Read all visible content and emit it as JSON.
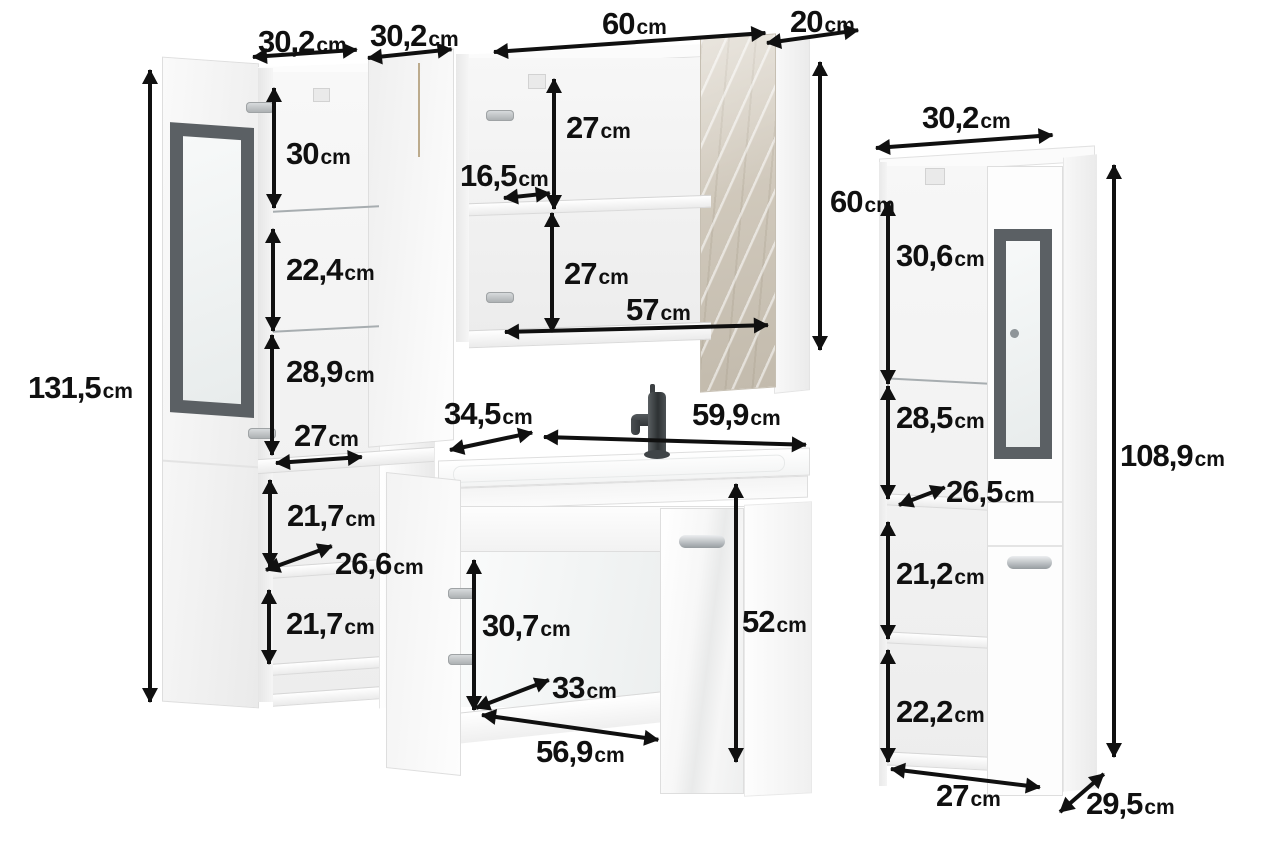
{
  "scene": {
    "background": "#ffffff",
    "arrow_color": "#101010",
    "text_color": "#101010",
    "glass_frame_color": "#5b6064",
    "marble_door_color": "#d1cabe"
  },
  "left_cabinet": {
    "description": "tall cabinet with open glass door",
    "dims": {
      "door_width": {
        "v": "30,2",
        "u": "cm"
      },
      "body_width": {
        "v": "30,2",
        "u": "cm"
      },
      "height": {
        "v": "131,5",
        "u": "cm"
      },
      "section_1": {
        "v": "30",
        "u": "cm"
      },
      "section_2": {
        "v": "22,4",
        "u": "cm"
      },
      "section_3": {
        "v": "28,9",
        "u": "cm"
      },
      "inner_width": {
        "v": "27",
        "u": "cm"
      },
      "section_4": {
        "v": "21,7",
        "u": "cm"
      },
      "inner_depth": {
        "v": "26,6",
        "u": "cm"
      },
      "section_5": {
        "v": "21,7",
        "u": "cm"
      }
    }
  },
  "mirror_cabinet": {
    "description": "wall cabinet with open doors",
    "dims": {
      "width": {
        "v": "60",
        "u": "cm"
      },
      "depth": {
        "v": "20",
        "u": "cm"
      },
      "section_top": {
        "v": "27",
        "u": "cm"
      },
      "shelf_depth": {
        "v": "16,5",
        "u": "cm"
      },
      "section_bot": {
        "v": "27",
        "u": "cm"
      },
      "inner_width": {
        "v": "57",
        "u": "cm"
      },
      "height": {
        "v": "60",
        "u": "cm"
      }
    }
  },
  "sink_vanity": {
    "description": "washbasin cabinet with open door",
    "dims": {
      "basin_depth": {
        "v": "34,5",
        "u": "cm"
      },
      "basin_width": {
        "v": "59,9",
        "u": "cm"
      },
      "door_height": {
        "v": "30,7",
        "u": "cm"
      },
      "inner_depth": {
        "v": "33",
        "u": "cm"
      },
      "inner_width": {
        "v": "56,9",
        "u": "cm"
      },
      "height": {
        "v": "52",
        "u": "cm"
      }
    }
  },
  "right_cabinet": {
    "description": "tall cabinet with glass door",
    "dims": {
      "width": {
        "v": "30,2",
        "u": "cm"
      },
      "section_1": {
        "v": "30,6",
        "u": "cm"
      },
      "section_2": {
        "v": "28,5",
        "u": "cm"
      },
      "inner_depth": {
        "v": "26,5",
        "u": "cm"
      },
      "section_3": {
        "v": "21,2",
        "u": "cm"
      },
      "section_4": {
        "v": "22,2",
        "u": "cm"
      },
      "inner_width": {
        "v": "27",
        "u": "cm"
      },
      "depth": {
        "v": "29,5",
        "u": "cm"
      },
      "height": {
        "v": "108,9",
        "u": "cm"
      }
    }
  }
}
